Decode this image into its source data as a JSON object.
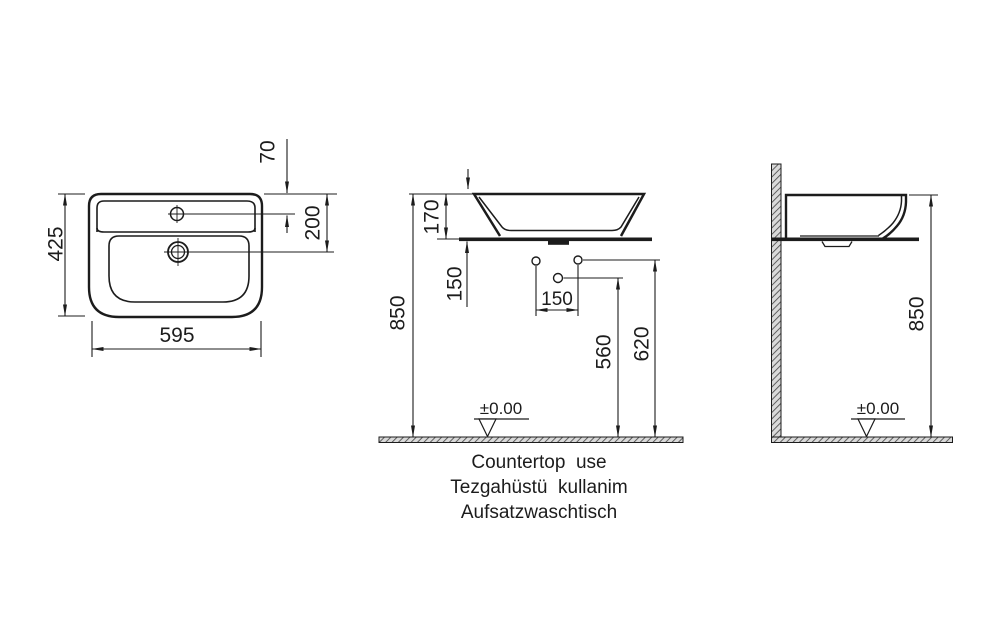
{
  "title": "Countertop washbasin installation drawing",
  "colors": {
    "line": "#1c1c1c",
    "background": "#ffffff"
  },
  "top_view": {
    "width": "595",
    "depth": "425",
    "tap_offset": "70",
    "drain_offset": "200"
  },
  "front_view": {
    "rim_height": "850",
    "basin_height": "170",
    "countertop_to_hole": "150",
    "hole_spacing": "150",
    "drain_hole_height": "560",
    "supply_hole_height": "620",
    "datum": "±0.00"
  },
  "side_view": {
    "rim_height": "850",
    "datum": "±0.00"
  },
  "caption": {
    "line1": "Countertop  use",
    "line2": "Tezgahüstü  kullanim",
    "line3": "Aufsatzwaschtisch"
  }
}
